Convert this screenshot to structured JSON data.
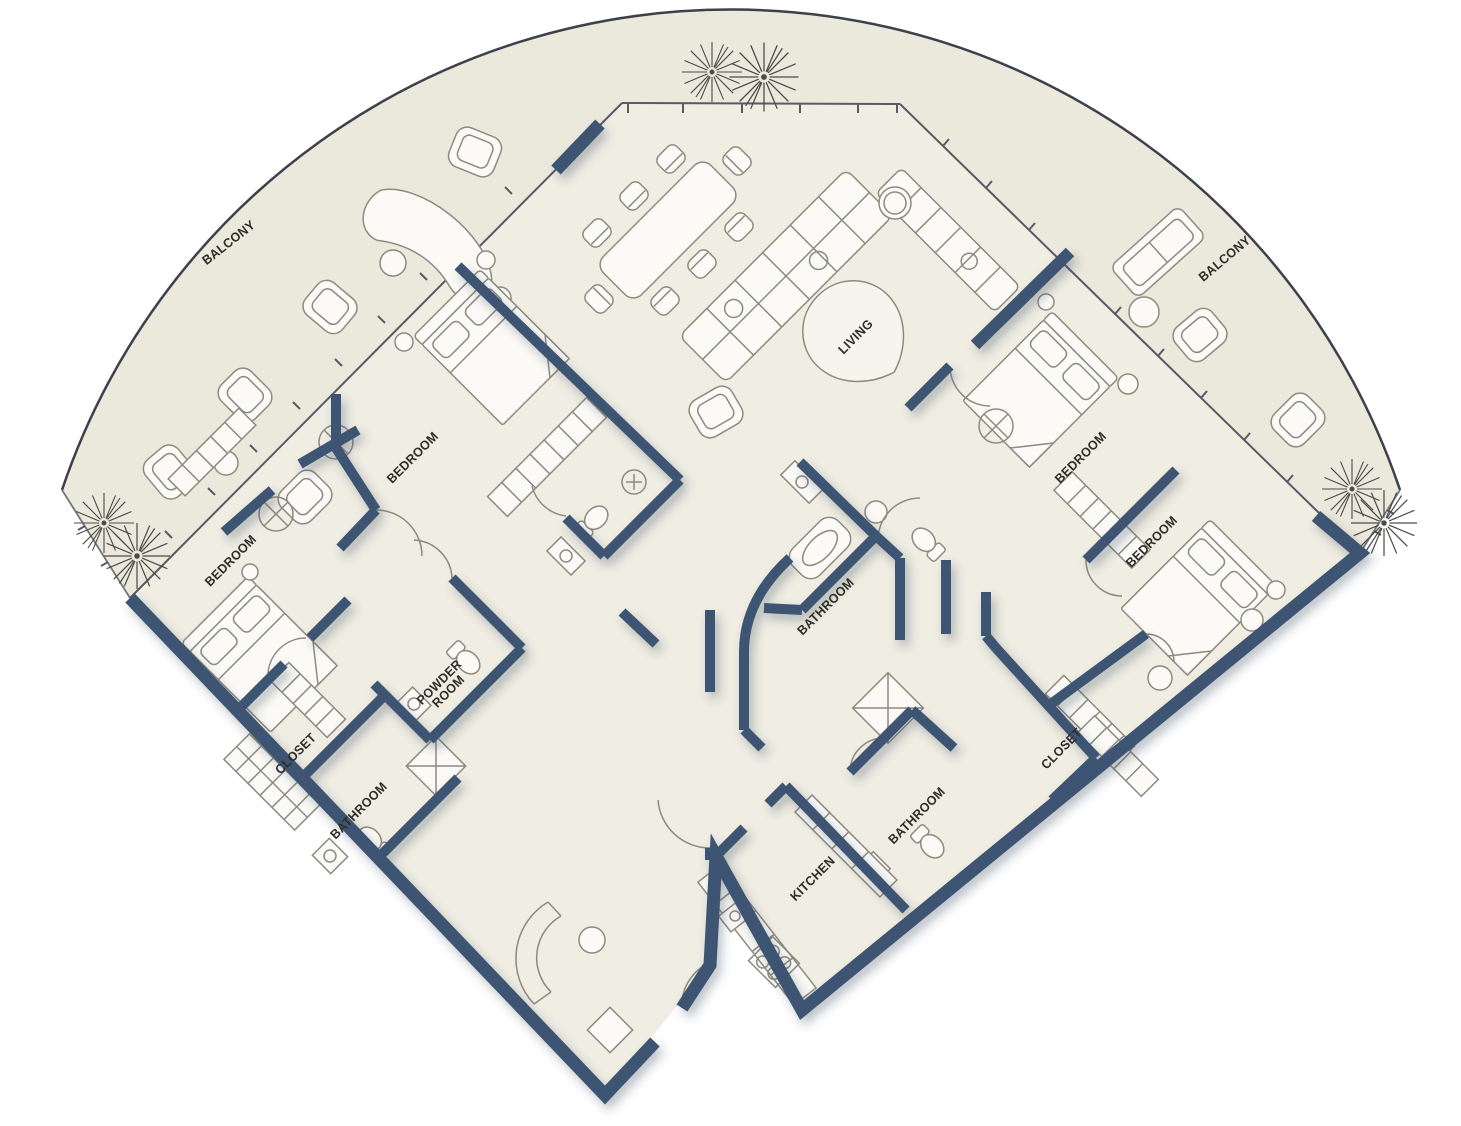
{
  "floorplan": {
    "type": "residential-floor-plan",
    "colors": {
      "wall": "#3d5472",
      "floor": "#f0ede3",
      "balcony": "#ebe8dc",
      "outline": "#3c414b",
      "furn": "#8d8a80",
      "label": "#2f2d28"
    },
    "labels": [
      {
        "id": "balcony-left",
        "text": "BALCONY",
        "x": 229,
        "y": 243,
        "rot": -38
      },
      {
        "id": "balcony-right",
        "text": "BALCONY",
        "x": 1225,
        "y": 259,
        "rot": -40
      },
      {
        "id": "bedroom-upper-left",
        "text": "BEDROOM",
        "x": 413,
        "y": 458,
        "rot": -45
      },
      {
        "id": "bedroom-far-left",
        "text": "BEDROOM",
        "x": 231,
        "y": 561,
        "rot": -45
      },
      {
        "id": "living",
        "text": "LIVING",
        "x": 856,
        "y": 337,
        "rot": -45
      },
      {
        "id": "bedroom-right-upper",
        "text": "BEDROOM",
        "x": 1081,
        "y": 458,
        "rot": -45
      },
      {
        "id": "bedroom-right-lower",
        "text": "BEDROOM",
        "x": 1152,
        "y": 542,
        "rot": -45
      },
      {
        "id": "bathroom-center",
        "text": "BATHROOM",
        "x": 826,
        "y": 607,
        "rot": -45
      },
      {
        "id": "powder-room",
        "text": "POWDER\nROOM",
        "x": 444,
        "y": 687,
        "rot": -45
      },
      {
        "id": "closet-left",
        "text": "CLOSET",
        "x": 296,
        "y": 754,
        "rot": -45
      },
      {
        "id": "bathroom-left",
        "text": "BATHROOM",
        "x": 359,
        "y": 811,
        "rot": -45
      },
      {
        "id": "closet-right",
        "text": "CLOSET",
        "x": 1062,
        "y": 749,
        "rot": -45
      },
      {
        "id": "bathroom-right",
        "text": "BATHROOM",
        "x": 917,
        "y": 816,
        "rot": -45
      },
      {
        "id": "kitchen",
        "text": "KITCHEN",
        "x": 813,
        "y": 879,
        "rot": -45
      }
    ]
  }
}
